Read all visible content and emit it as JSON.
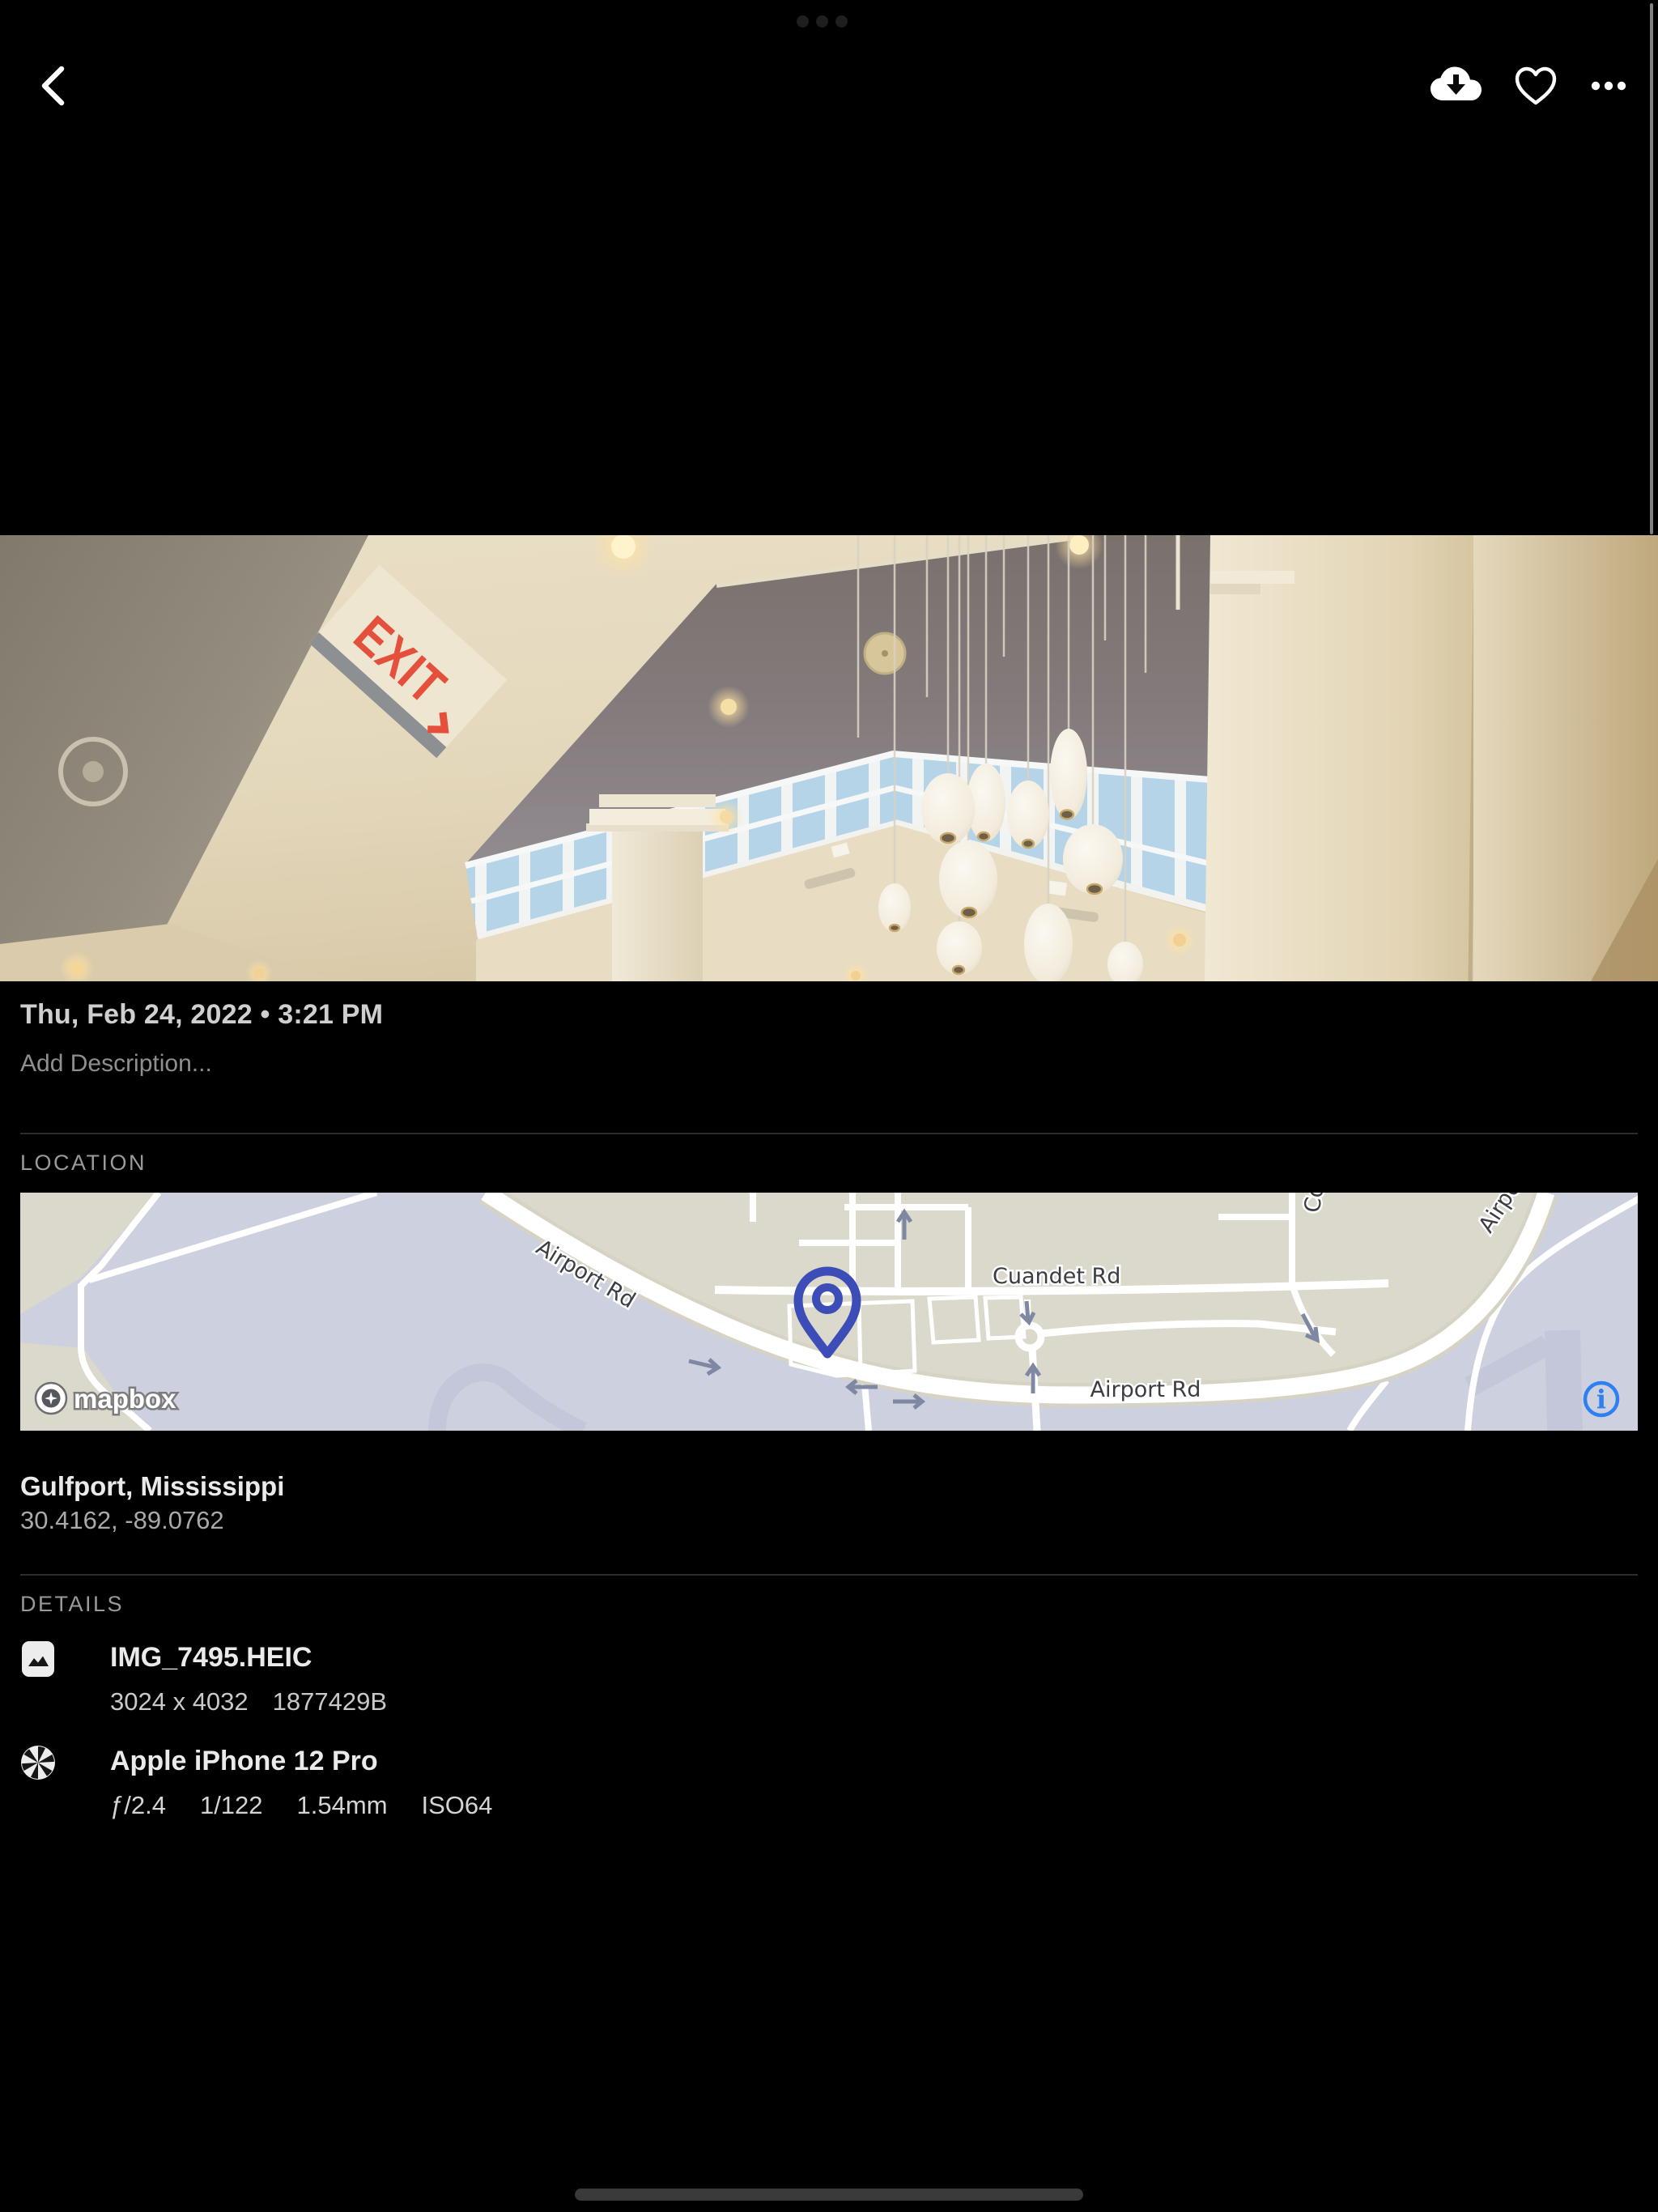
{
  "status": {
    "app_switcher_dots": 3
  },
  "toolbar": {
    "back_icon": "chevron-left",
    "download_icon": "cloud-download",
    "favorite_icon": "heart-outline",
    "more_icon": "ellipsis-horizontal"
  },
  "photo": {
    "exit_sign_text": "EXIT"
  },
  "meta": {
    "date": "Thu, Feb 24, 2022 • 3:21 PM",
    "description_placeholder": "Add Description..."
  },
  "location": {
    "label": "LOCATION",
    "place": "Gulfport, Mississippi",
    "coordinates": "30.4162, -89.0762",
    "map": {
      "road_label_diagonal": "Airport Rd",
      "road_label_cuandet": "Cuandet Rd",
      "road_label_bottom": "Airport Rd",
      "road_label_top_right": "Airport Rd",
      "road_label_top_partial": "Cowan Rd",
      "attribution": "mapbox",
      "info_symbol": "i",
      "colors": {
        "land": "#dbd8cc",
        "apron": "#cdd1df",
        "road": "#ffffff",
        "pin": "#3d4db7",
        "info_blue": "#2e80f0"
      }
    }
  },
  "details": {
    "label": "DETAILS",
    "file": {
      "icon": "image",
      "name": "IMG_7495.HEIC",
      "dimensions": "3024 x 4032",
      "filesize": "1877429B"
    },
    "camera": {
      "icon": "aperture",
      "name": "Apple iPhone 12 Pro",
      "aperture": "ƒ/2.4",
      "shutter_speed": "1/122",
      "focal_length": "1.54mm",
      "iso": "ISO64"
    }
  }
}
